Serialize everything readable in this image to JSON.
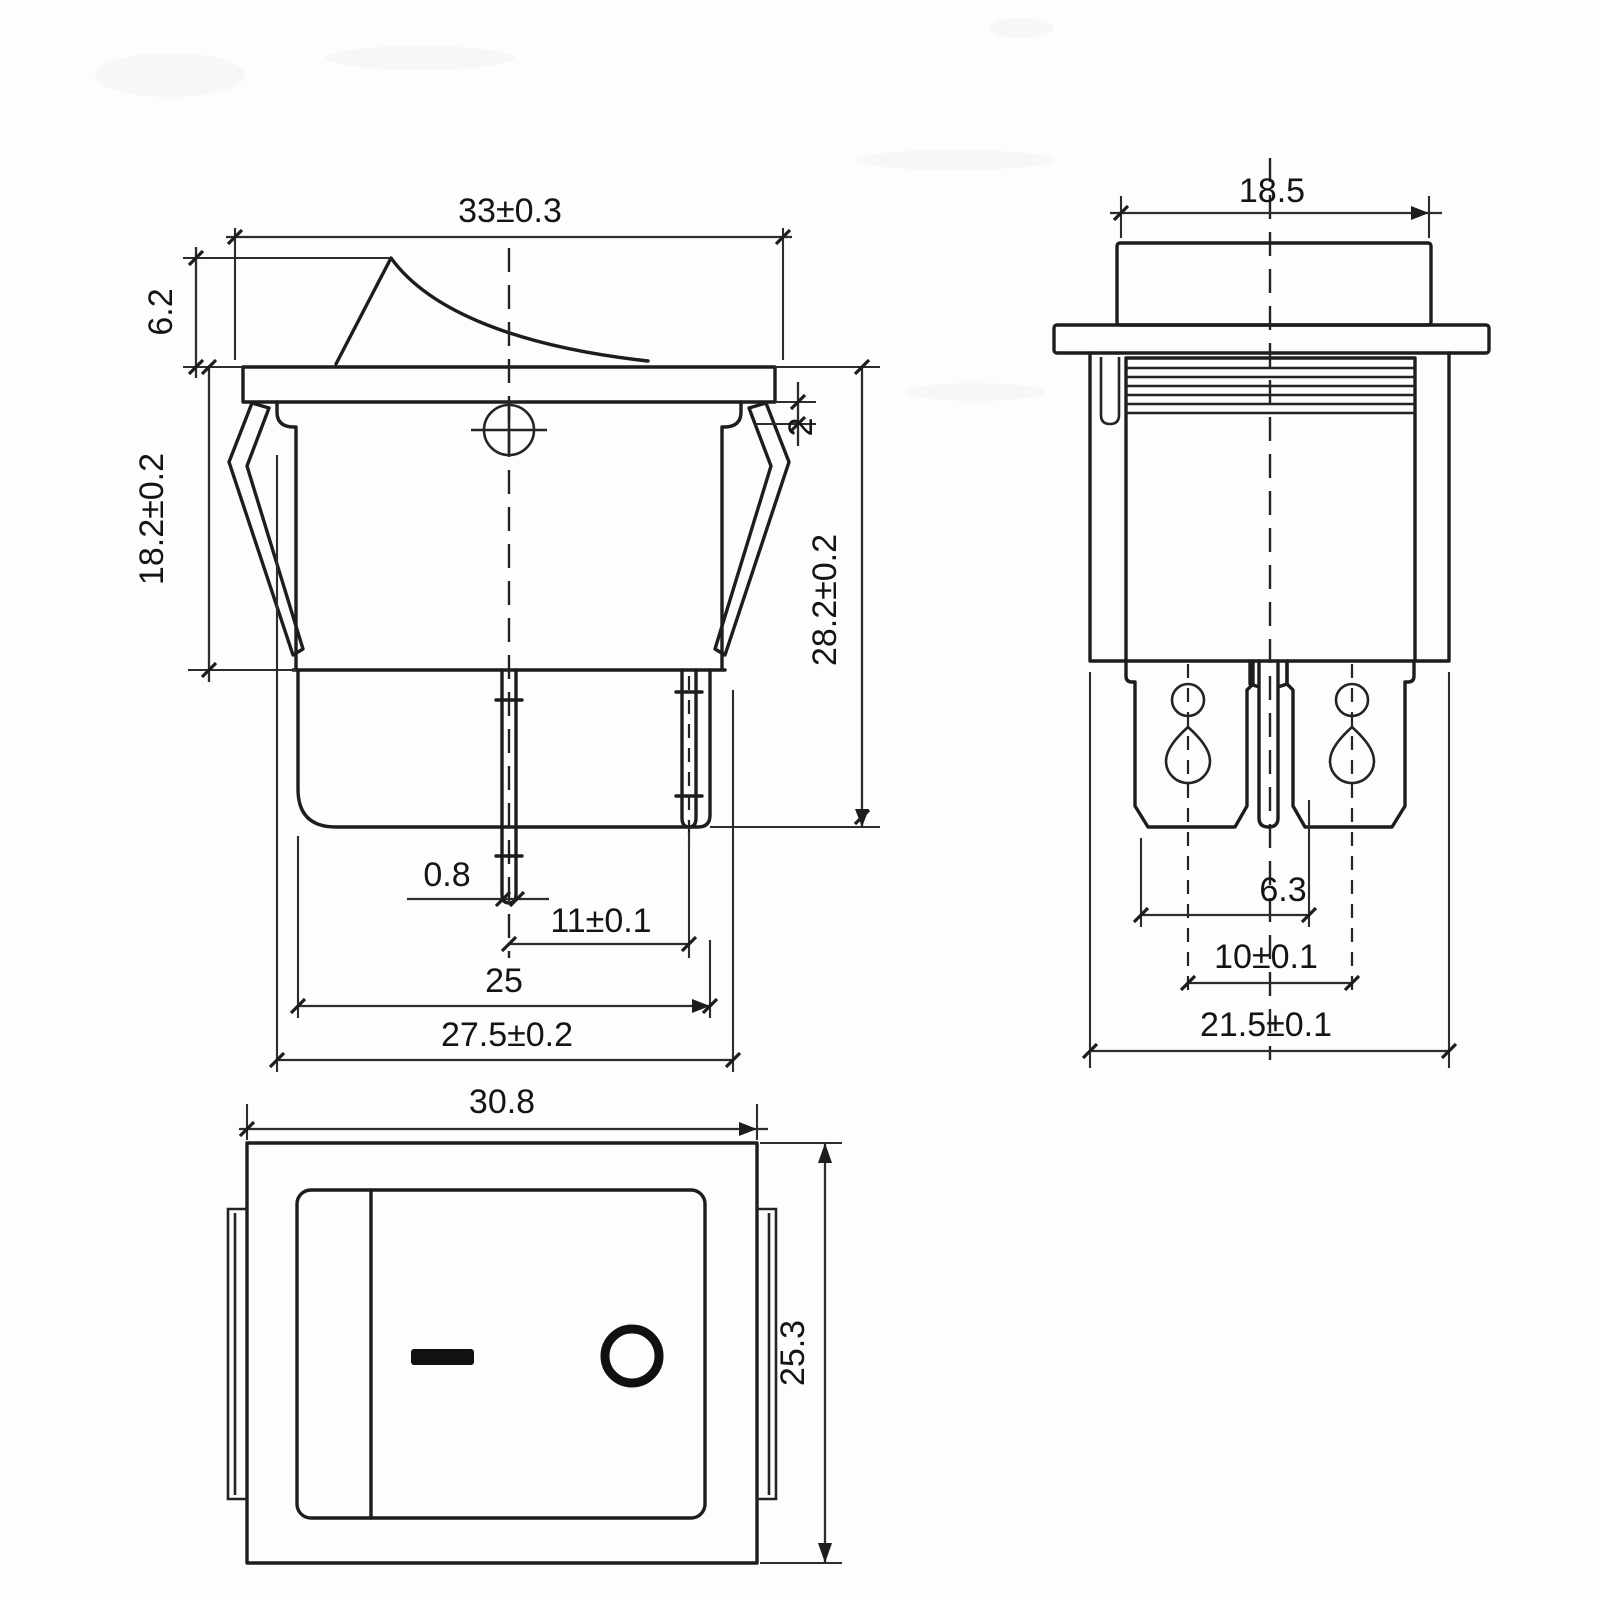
{
  "side_view": {
    "dims": {
      "flange_width": "33±0.3",
      "rocker_height": "6.2",
      "body_depth": "18.2±0.2",
      "panel_step": "2",
      "overall_height": "28.2±0.2",
      "pin_thickness": "0.8",
      "pin_pitch": "11±0.1",
      "body_width": "25",
      "clip_span": "27.5±0.2"
    }
  },
  "front_view": {
    "dims": {
      "rocker_width": "18.5",
      "terminal_offset": "6.3",
      "terminal_pitch": "10±0.1",
      "body_width": "21.5±0.1"
    }
  },
  "top_view": {
    "dims": {
      "width": "30.8",
      "height": "25.3"
    },
    "icons": {
      "on_marking": "on-symbol-bar",
      "off_marking": "off-symbol-ring"
    }
  }
}
